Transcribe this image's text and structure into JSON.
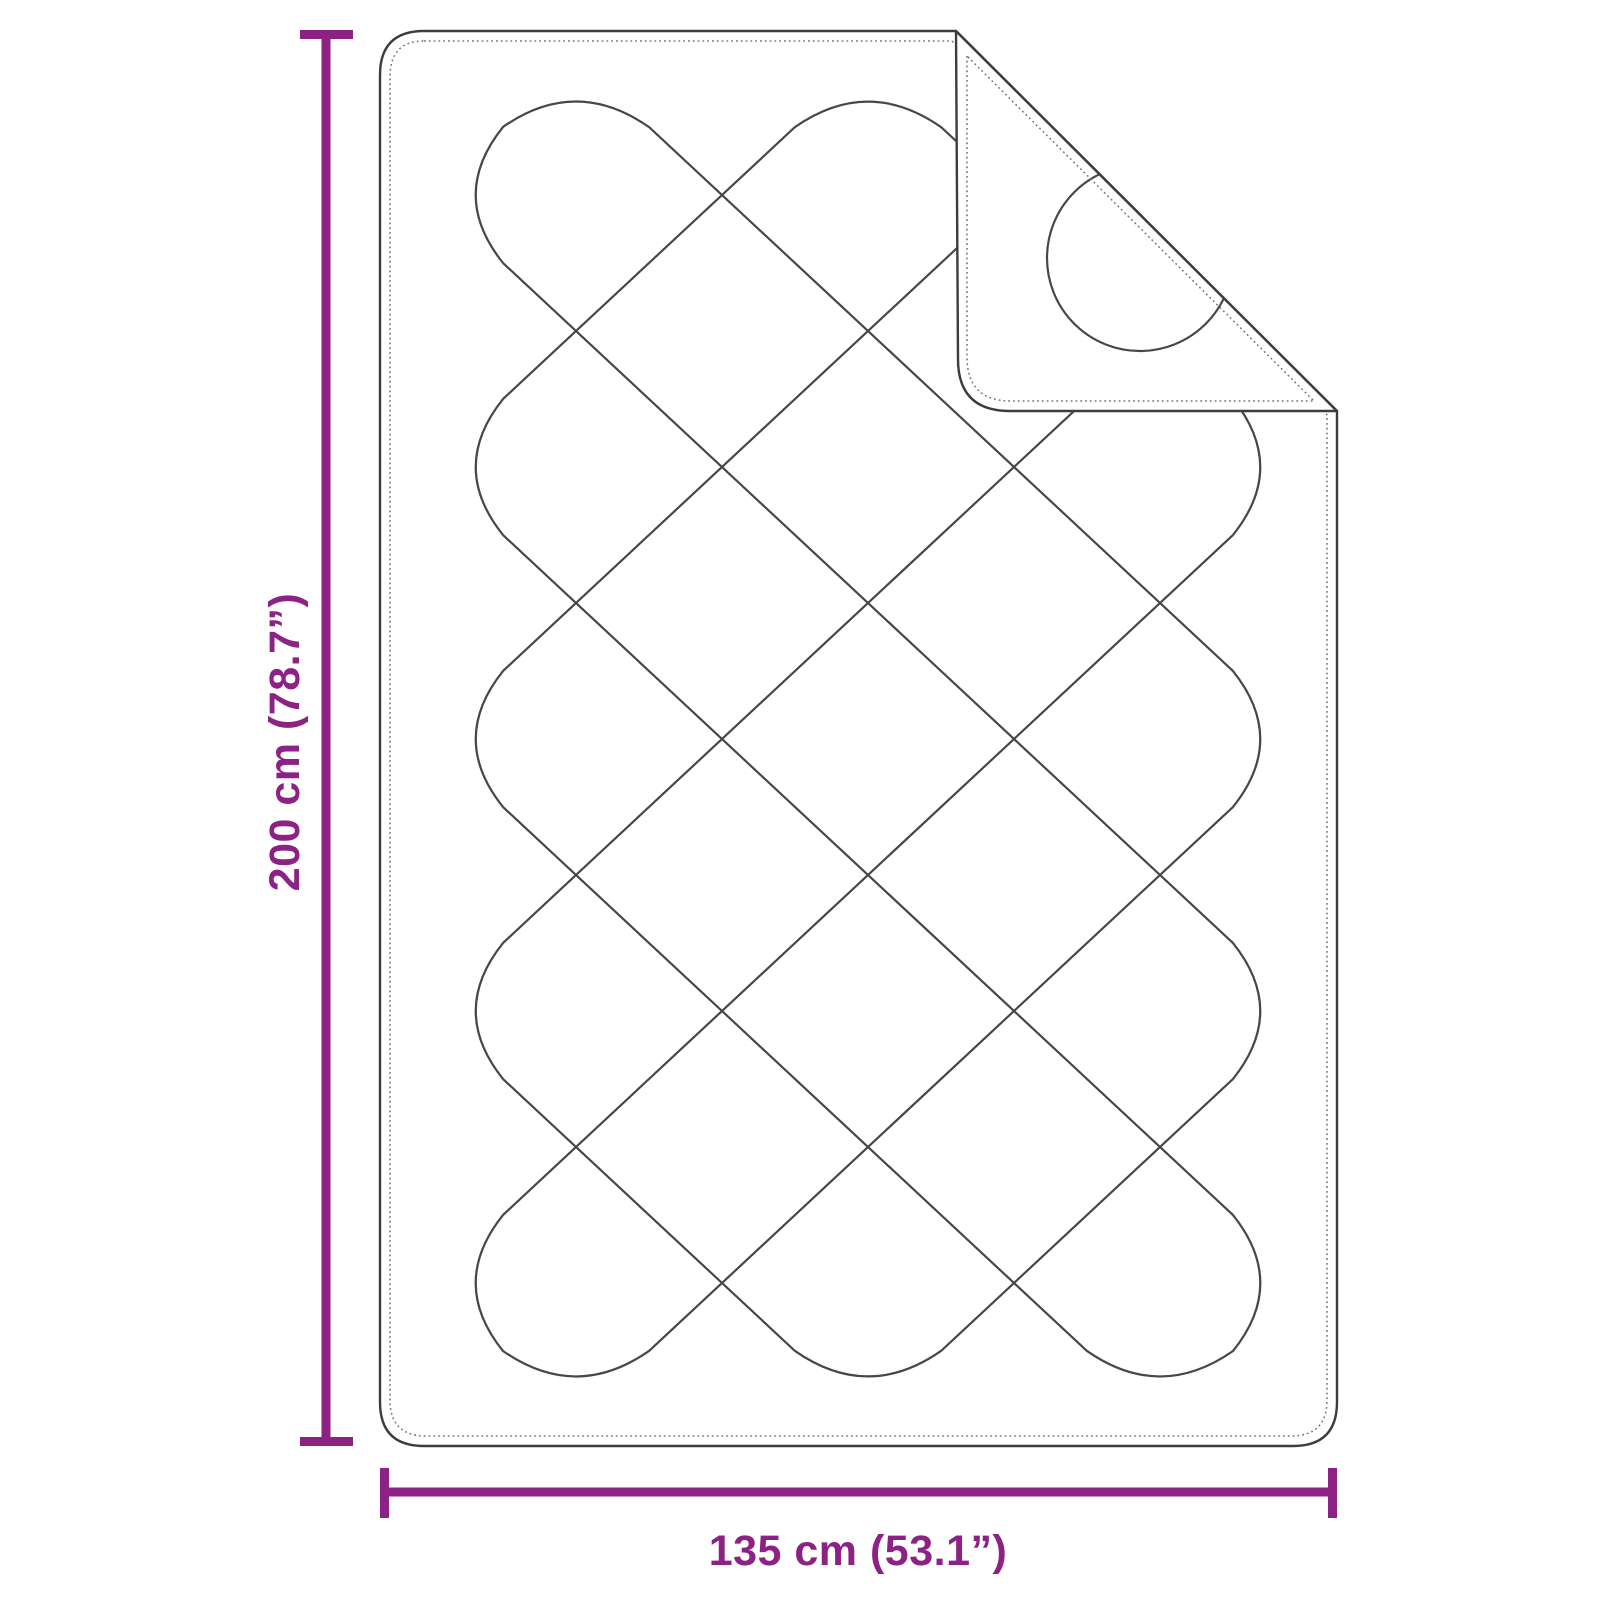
{
  "diagram": {
    "subject": "quilted-blanket-with-folded-corner",
    "height_label": "200 cm (78.7”)",
    "width_label": "135 cm (53.1”)",
    "height_cm": 200,
    "height_in": 78.7,
    "width_cm": 135,
    "width_in": 53.1,
    "colors": {
      "dimension": "#8C2284",
      "outline": "#3D3D3D",
      "pattern": "#474747",
      "stitch": "#7A7A7A",
      "background": "#FFFFFF"
    }
  }
}
